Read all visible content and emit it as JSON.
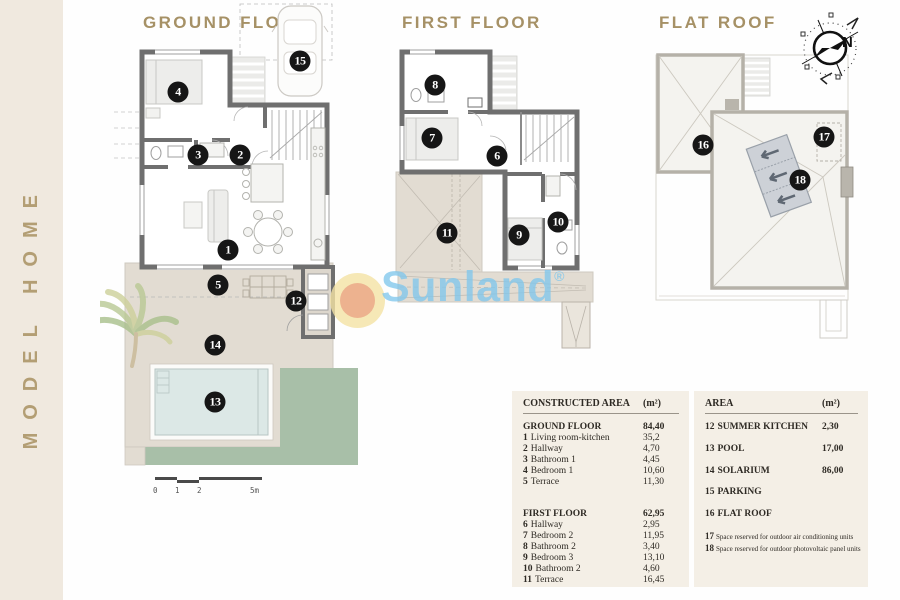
{
  "brand": {
    "text": "MODEL HOME"
  },
  "plans": {
    "ground": {
      "title": "GROUND FLOOR",
      "markers": [
        "1",
        "2",
        "3",
        "4",
        "5",
        "12",
        "13",
        "14",
        "15"
      ]
    },
    "first": {
      "title": "FIRST FLOOR",
      "markers": [
        "6",
        "7",
        "8",
        "9",
        "10",
        "11"
      ]
    },
    "roof": {
      "title": "FLAT ROOF",
      "markers": [
        "16",
        "17",
        "18"
      ]
    }
  },
  "compass": {
    "north": "N"
  },
  "watermark": {
    "text": "Sunland",
    "reg": "®"
  },
  "scalebar": {
    "t0": "0",
    "t1": "1",
    "t2": "2",
    "t5": "5m"
  },
  "colors": {
    "accent_gold": "#a69166",
    "sidebar_cream": "#f0e9df",
    "table_bg": "#f4efe6",
    "wall_gray": "#6f6f6f",
    "terrace_beige": "#e2dcd2",
    "pool_blue": "#dce8e6",
    "garden_green": "#a8bfa8",
    "watermark_blue": "#80c6ec",
    "sun_outer": "#f4e2a4",
    "sun_inner": "#e99c80"
  },
  "tables": {
    "constructed": {
      "header": {
        "label": "CONSTRUCTED AREA",
        "unit": "(m²)"
      },
      "sections": [
        {
          "title": "GROUND FLOOR",
          "value": "84,40",
          "rows": [
            {
              "num": "1",
              "label": "Living room-kitchen",
              "value": "35,2"
            },
            {
              "num": "2",
              "label": "Hallway",
              "value": "4,70"
            },
            {
              "num": "3",
              "label": "Bathroom 1",
              "value": "4,45"
            },
            {
              "num": "4",
              "label": "Bedroom 1",
              "value": "10,60"
            },
            {
              "num": "5",
              "label": "Terrace",
              "value": "11,30"
            }
          ]
        },
        {
          "title": "FIRST FLOOR",
          "value": "62,95",
          "rows": [
            {
              "num": "6",
              "label": "Hallway",
              "value": "2,95"
            },
            {
              "num": "7",
              "label": "Bedroom 2",
              "value": "11,95"
            },
            {
              "num": "8",
              "label": "Bathroom 2",
              "value": "3,40"
            },
            {
              "num": "9",
              "label": "Bedroom 3",
              "value": "13,10"
            },
            {
              "num": "10",
              "label": "Bathroom 2",
              "value": "4,60"
            },
            {
              "num": "11",
              "label": "Terrace",
              "value": "16,45"
            }
          ]
        }
      ]
    },
    "area": {
      "header": {
        "label": "AREA",
        "unit": "(m²)"
      },
      "rows": [
        {
          "num": "12",
          "label": "SUMMER KITCHEN",
          "value": "2,30"
        },
        {
          "num": "13",
          "label": "POOL",
          "value": "17,00"
        },
        {
          "num": "14",
          "label": "SOLARIUM",
          "value": "86,00"
        },
        {
          "num": "15",
          "label": "PARKING",
          "value": ""
        },
        {
          "num": "16",
          "label": "FLAT ROOF",
          "value": ""
        }
      ],
      "notes": [
        {
          "num": "17",
          "label": "Space reserved for outdoor air conditioning units"
        },
        {
          "num": "18",
          "label": "Space reserved for outdoor photovoltaic panel units"
        }
      ]
    }
  }
}
